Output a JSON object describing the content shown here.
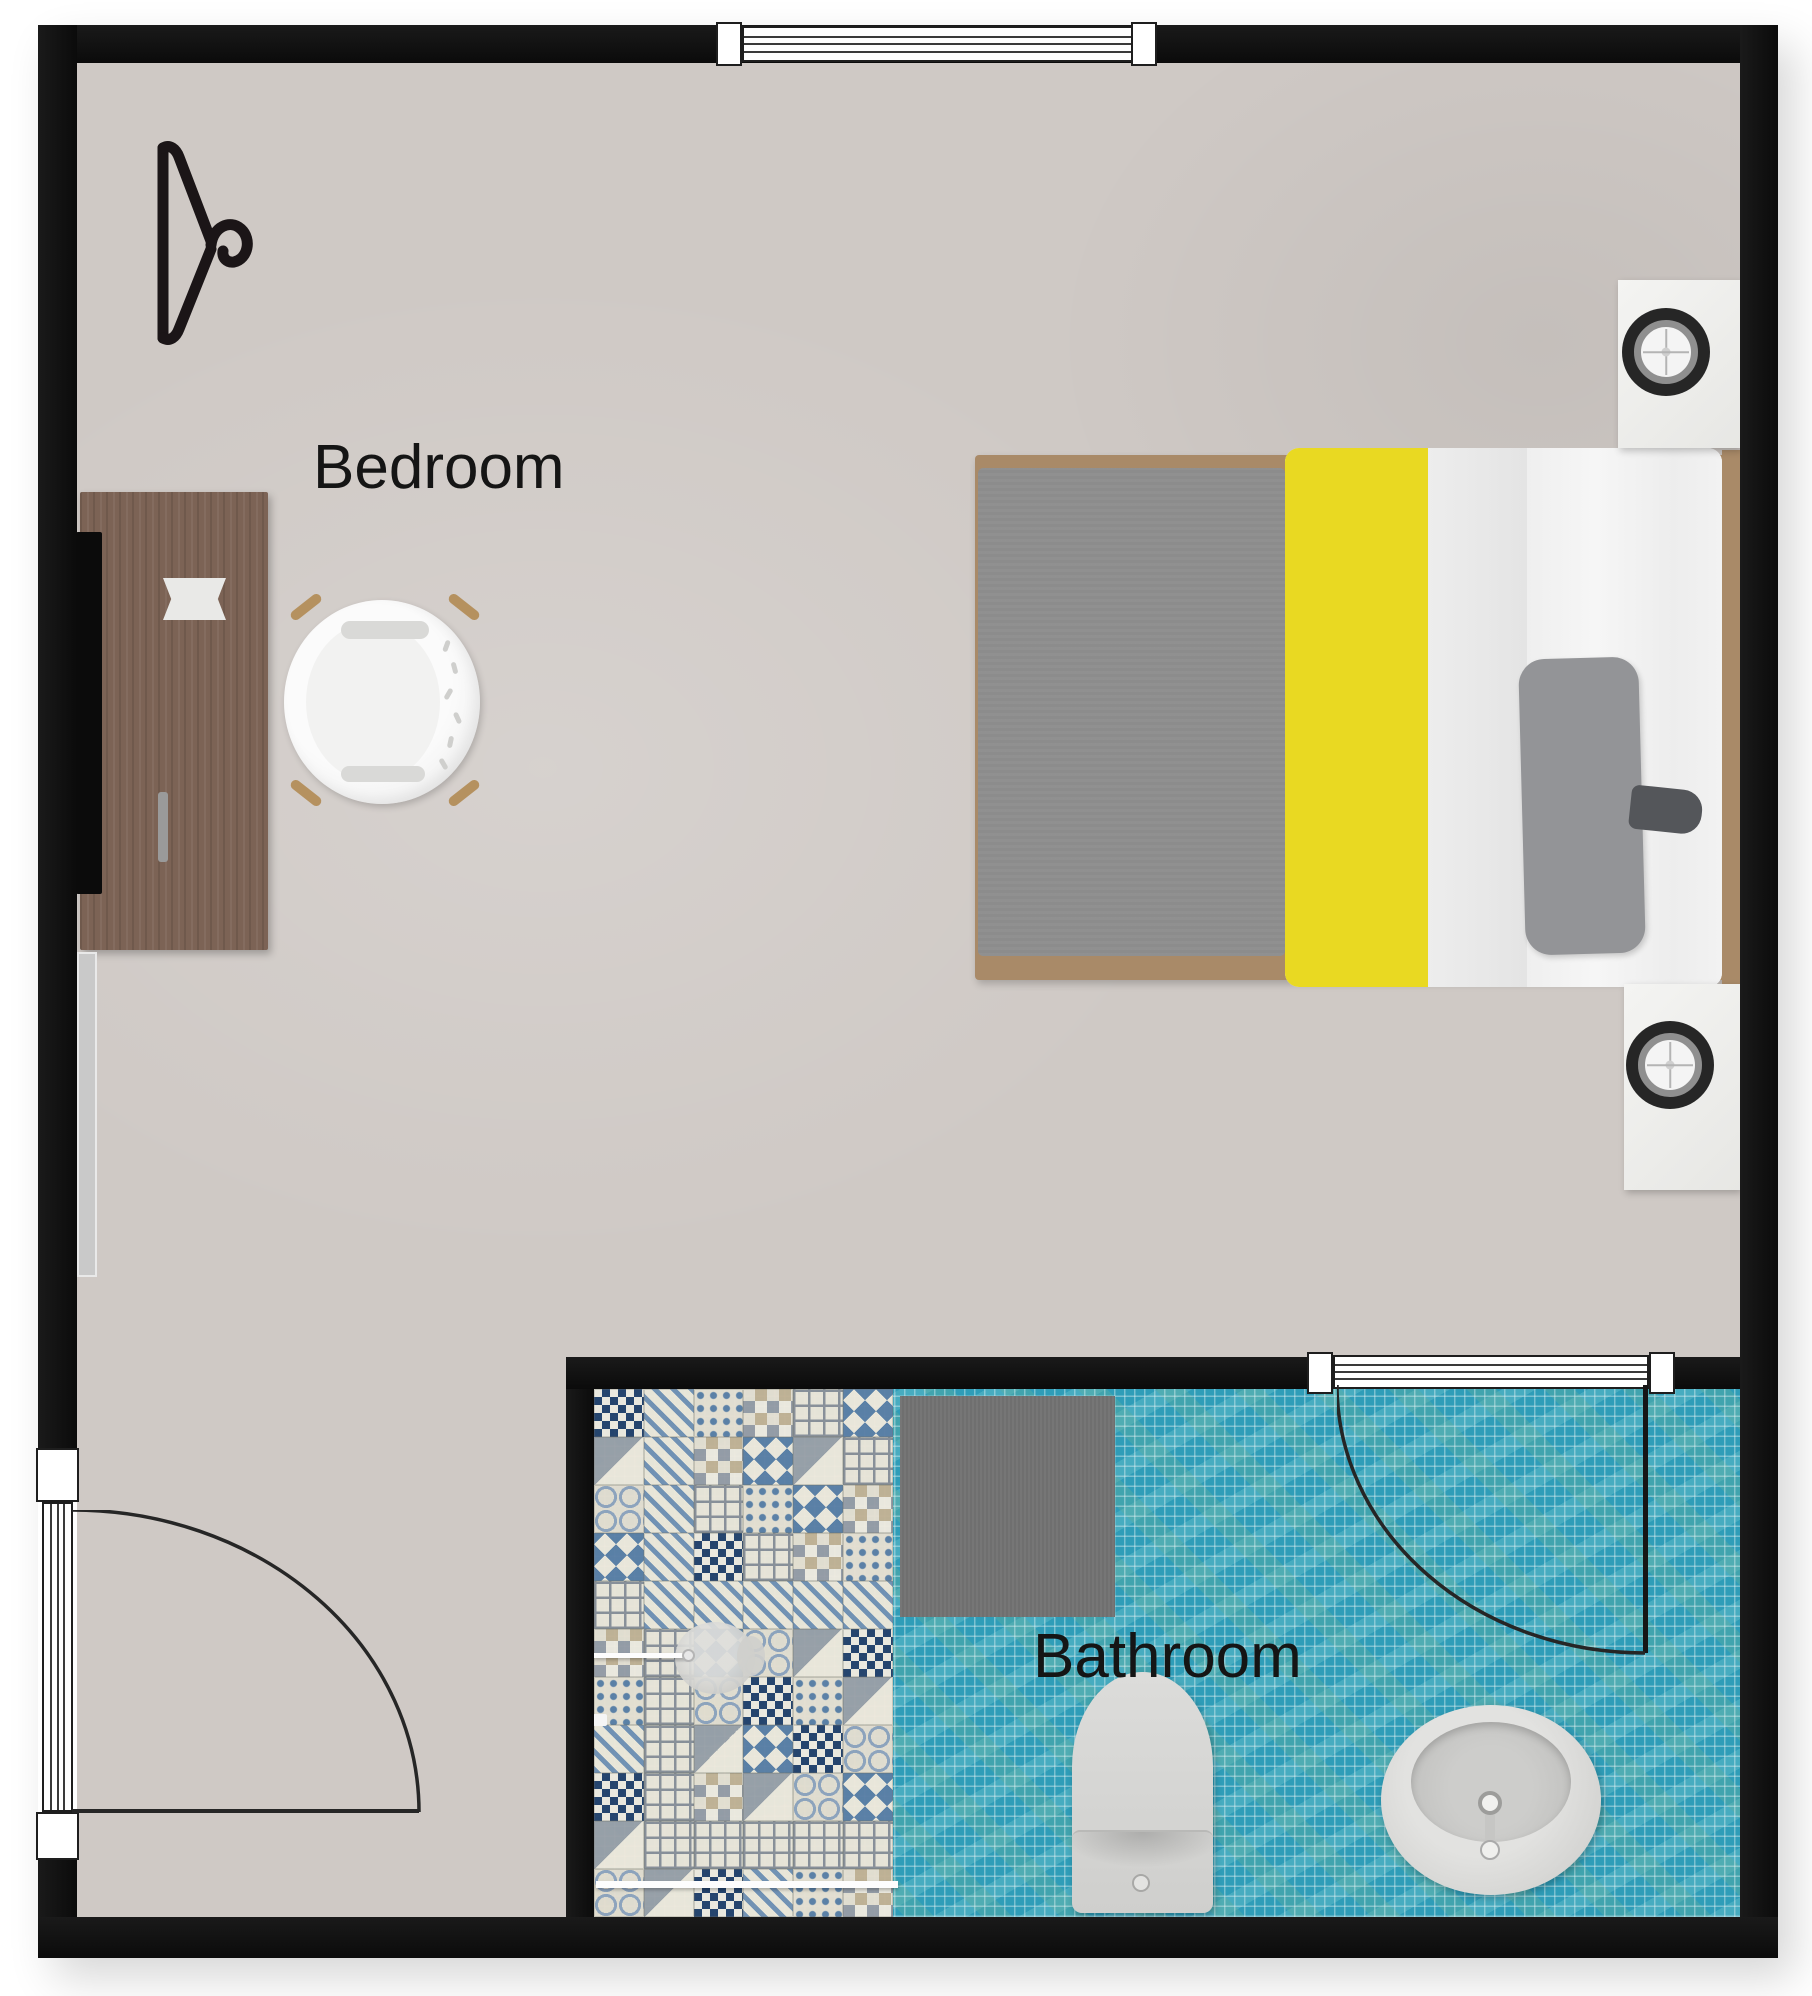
{
  "plan": {
    "type": "floor-plan-top-view",
    "rooms": [
      {
        "id": "bedroom",
        "label": "Bedroom"
      },
      {
        "id": "bathroom",
        "label": "Bathroom"
      }
    ],
    "furniture": [
      "clothes-hanger",
      "desk",
      "tv",
      "desk-paper",
      "mirror",
      "chair",
      "double-bed",
      "pillow",
      "nightstand-top",
      "nightstand-bottom",
      "speaker-top",
      "speaker-bottom",
      "shower",
      "bath-mat",
      "toilet",
      "sink"
    ],
    "doors": [
      {
        "name": "entry-door",
        "wall": "left",
        "swing": "quarter-arc"
      },
      {
        "name": "bathroom-door",
        "wall": "bathroom-top",
        "swing": "quarter-arc"
      }
    ],
    "windows": [
      {
        "name": "bedroom-window",
        "wall": "top"
      },
      {
        "name": "bathroom-window",
        "wall": "bathroom-top"
      }
    ],
    "colors": {
      "wall": "#101010",
      "bedroom_floor": "#cfc9c5",
      "bathroom_tile": "#2f9db8",
      "bed_blanket": "#8c8c8c",
      "bed_yellow": "#e9d922",
      "bed_sheet": "#f3f3f3",
      "desk_wood": "#7c6355",
      "mat": "#6f6f6f"
    }
  }
}
